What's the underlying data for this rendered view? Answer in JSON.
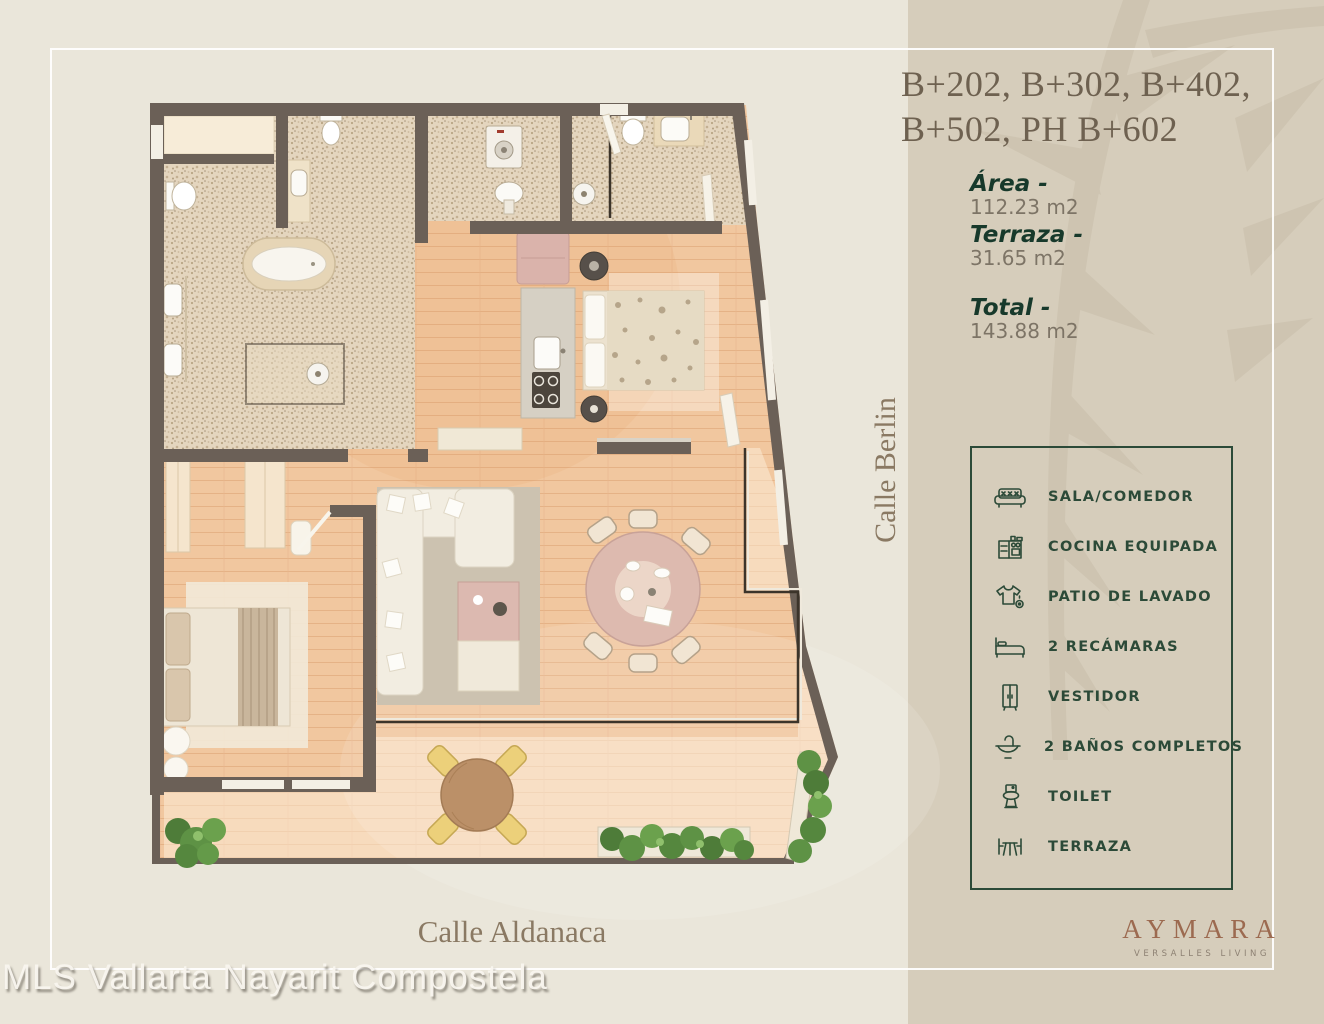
{
  "page": {
    "background_left": "#eae6da",
    "background_right": "#d6cdbb",
    "frame_color": "#ffffff",
    "accent_green": "#2c4a38",
    "wall_color": "#6b6057",
    "wood_color": "#f1c79f",
    "tile_color": "#e4d5be"
  },
  "header": {
    "title_full": "B+202, B+302, B+402, B+502, PH B+602",
    "title_lines": [
      "B+202, B+302, B+402,",
      "B+502, PH B+602"
    ]
  },
  "areas": {
    "area_label": "Área -",
    "area_value": "112.23 m2",
    "terrace_label": "Terraza -",
    "terrace_value": "31.65 m2",
    "total_label": "Total -",
    "total_value": "143.88 m2"
  },
  "legend": {
    "items": [
      {
        "icon": "sofa-icon",
        "label": "SALA/COMEDOR"
      },
      {
        "icon": "kitchen-icon",
        "label": "COCINA EQUIPADA"
      },
      {
        "icon": "laundry-icon",
        "label": "PATIO DE LAVADO"
      },
      {
        "icon": "bed-icon",
        "label": "2 RECÁMARAS"
      },
      {
        "icon": "wardrobe-icon",
        "label": "VESTIDOR"
      },
      {
        "icon": "sink-icon",
        "label": "2 BAÑOS COMPLETOS"
      },
      {
        "icon": "toilet-icon",
        "label": "TOILET"
      },
      {
        "icon": "terrace-table-icon",
        "label": "TERRAZA"
      }
    ]
  },
  "streets": {
    "vertical": "Calle Berlin",
    "horizontal": "Calle Aldanaca"
  },
  "brand": {
    "name": "AYMARA",
    "tagline": "VERSALLES LIVING"
  },
  "watermark": "MLS Vallarta Nayarit Compostela"
}
